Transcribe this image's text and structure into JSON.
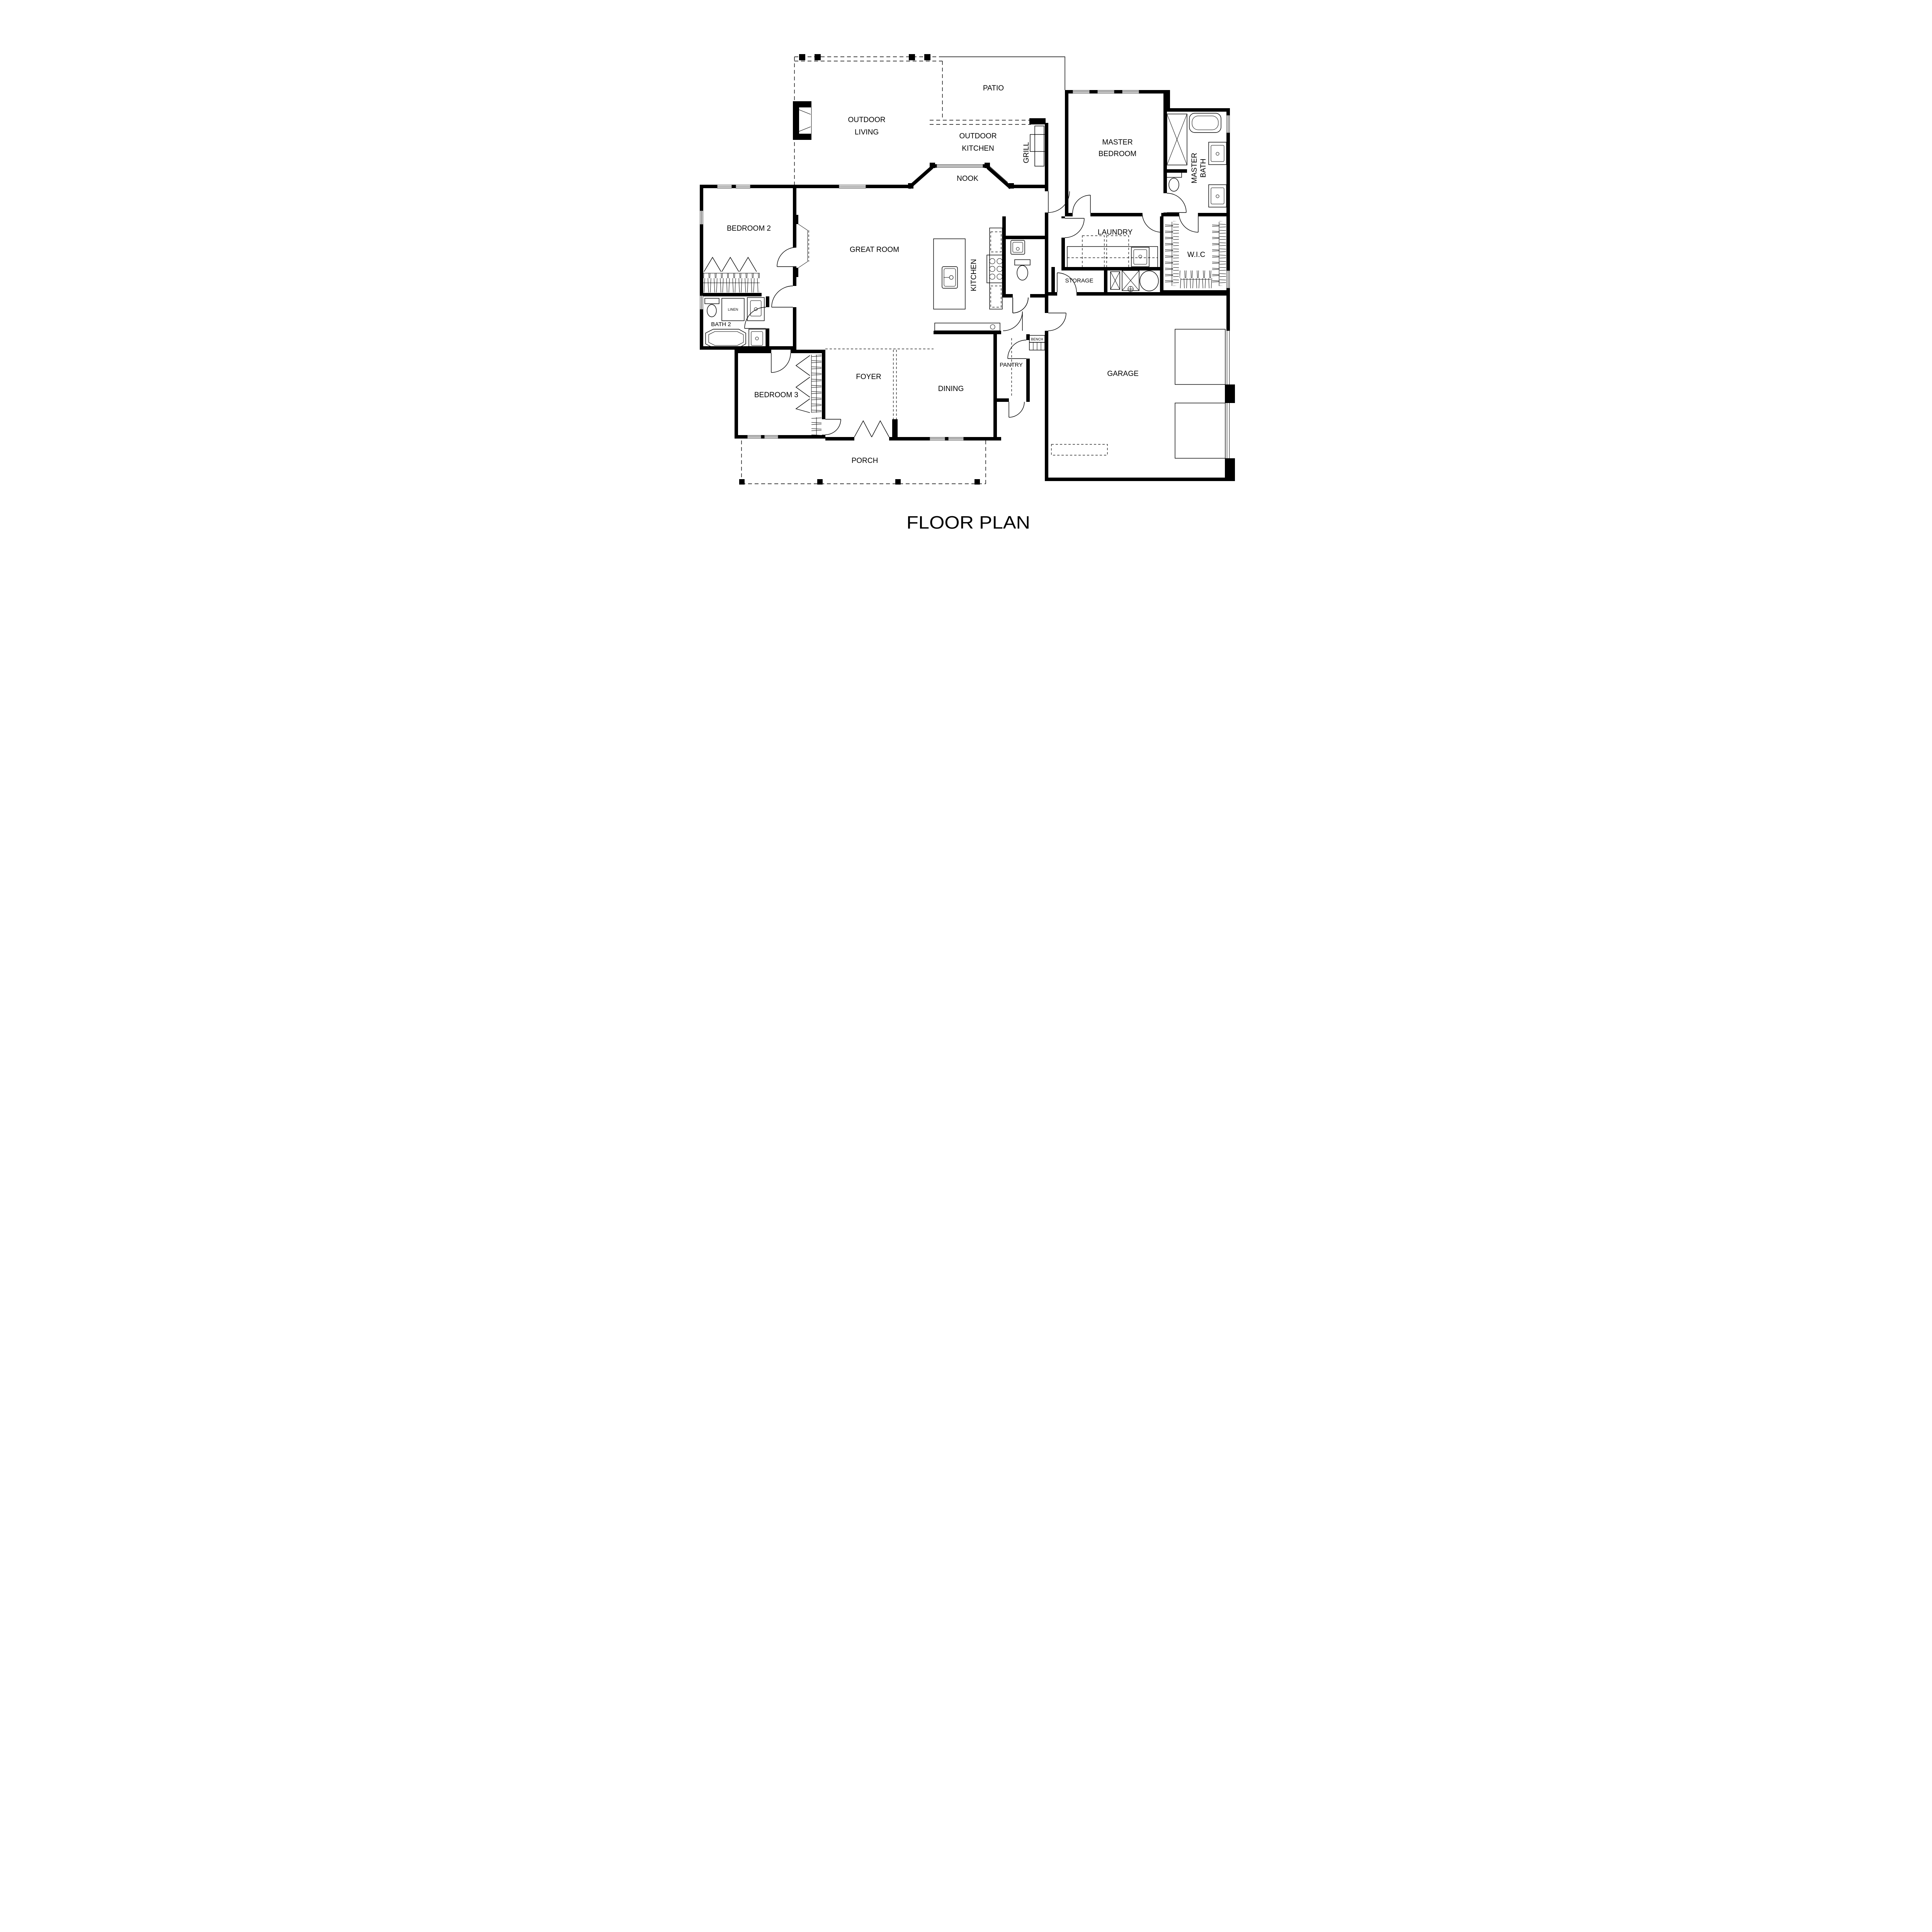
{
  "title": "FLOOR PLAN",
  "rooms": {
    "patio": "PATIO",
    "outdoor_living_line1": "OUTDOOR",
    "outdoor_living_line2": "LIVING",
    "outdoor_kitchen_line1": "OUTDOOR",
    "outdoor_kitchen_line2": "KITCHEN",
    "nook": "NOOK",
    "grill": "GRILL",
    "master_bedroom_line1": "MASTER",
    "master_bedroom_line2": "BEDROOM",
    "master_bath_line1": "MASTER",
    "master_bath_line2": "BATH",
    "bedroom2": "BEDROOM 2",
    "great_room": "GREAT ROOM",
    "kitchen": "KITCHEN",
    "laundry": "LAUNDRY",
    "wic": "W.I.C",
    "storage": "STORAGE",
    "linen": "LINEN",
    "bath2": "BATH 2",
    "bench": "BENCH",
    "bedroom3": "BEDROOM 3",
    "foyer": "FOYER",
    "dining": "DINING",
    "pantry": "PANTRY",
    "garage": "GARAGE",
    "porch": "PORCH"
  },
  "colors": {
    "ink": "#000000",
    "paper": "#ffffff"
  }
}
